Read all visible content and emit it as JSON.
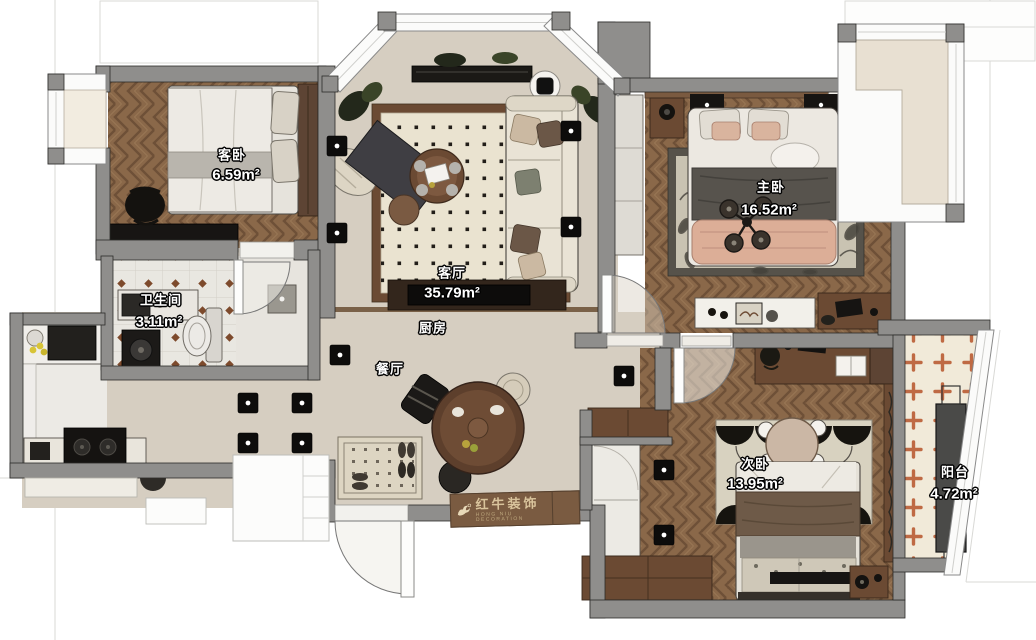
{
  "rooms": [
    {
      "key": "guest-bedroom",
      "name": "客卧",
      "area": "6.59m²"
    },
    {
      "key": "living-room",
      "name": "客厅",
      "area": "35.79m²"
    },
    {
      "key": "kitchen",
      "name": "厨房",
      "area": ""
    },
    {
      "key": "bathroom",
      "name": "卫生间",
      "area": "3.11m²"
    },
    {
      "key": "dining-room",
      "name": "餐厅",
      "area": ""
    },
    {
      "key": "master-bedroom",
      "name": "主卧",
      "area": "16.52m²"
    },
    {
      "key": "second-bedroom",
      "name": "次卧",
      "area": "13.95m²"
    },
    {
      "key": "balcony",
      "name": "阳台",
      "area": "4.72m²"
    }
  ],
  "watermark": {
    "brand": "红牛装饰",
    "tagline": "HONG NIU DECORATION",
    "logo": "bull-icon"
  },
  "colors": {
    "wall": "#8f8e8c",
    "wood_floor": "#8a6849",
    "beige_floor": "#d6cec1",
    "bath_tile_dot": "#7d4a2c",
    "balcony_cross": "#bf6a44",
    "watermark_bg": "#7a5b41",
    "watermark_text": "#d9c49c",
    "label_text": "#ffffff"
  }
}
